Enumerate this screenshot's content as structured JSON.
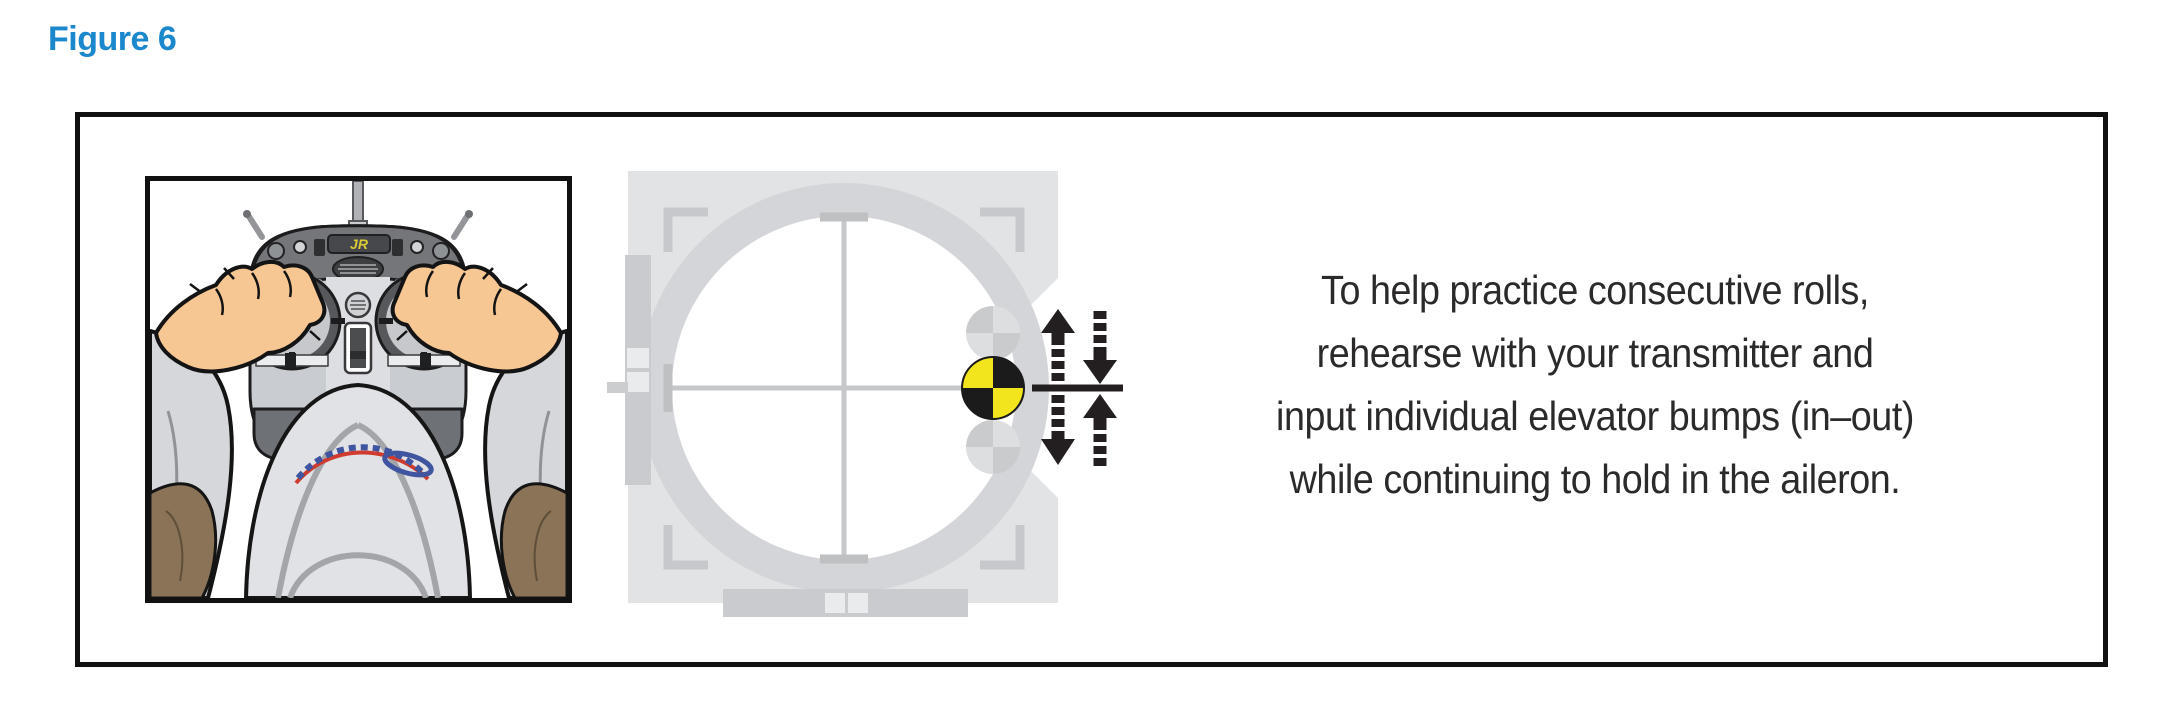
{
  "figure_label": "Figure 6",
  "transmitter": {
    "brand": "JR"
  },
  "caption": {
    "lines": [
      "To help practice consecutive rolls,",
      "rehearse with your transmitter and",
      "input individual elevator bumps (in–out)",
      "while continuing to hold in the aileron."
    ]
  },
  "diagram": {
    "marker_icon": "yellow-black-quartered-stick-top-marker",
    "ghost_marker_icon": "gray-quartered-stick-position",
    "arrow_icons": [
      "up-arrow-solid-dashed-tail",
      "down-arrow-dashed-tail",
      "down-arrow-dashed-tail",
      "up-arrow-solid-dashed-tail"
    ]
  },
  "colors": {
    "figure_label_blue": "#1b87cc",
    "caption_text": "#2b292a",
    "marker_yellow": "#f2e51e",
    "marker_black": "#1c1b1c",
    "diagram_plate_gray": "#e1e3e5",
    "diagram_ring_gray": "#d3d5d8",
    "arrow_black": "#231f20",
    "skin_tone": "#f6c693",
    "sleeve_gray": "#d5d7da",
    "sleeve_brown": "#8a7356"
  }
}
